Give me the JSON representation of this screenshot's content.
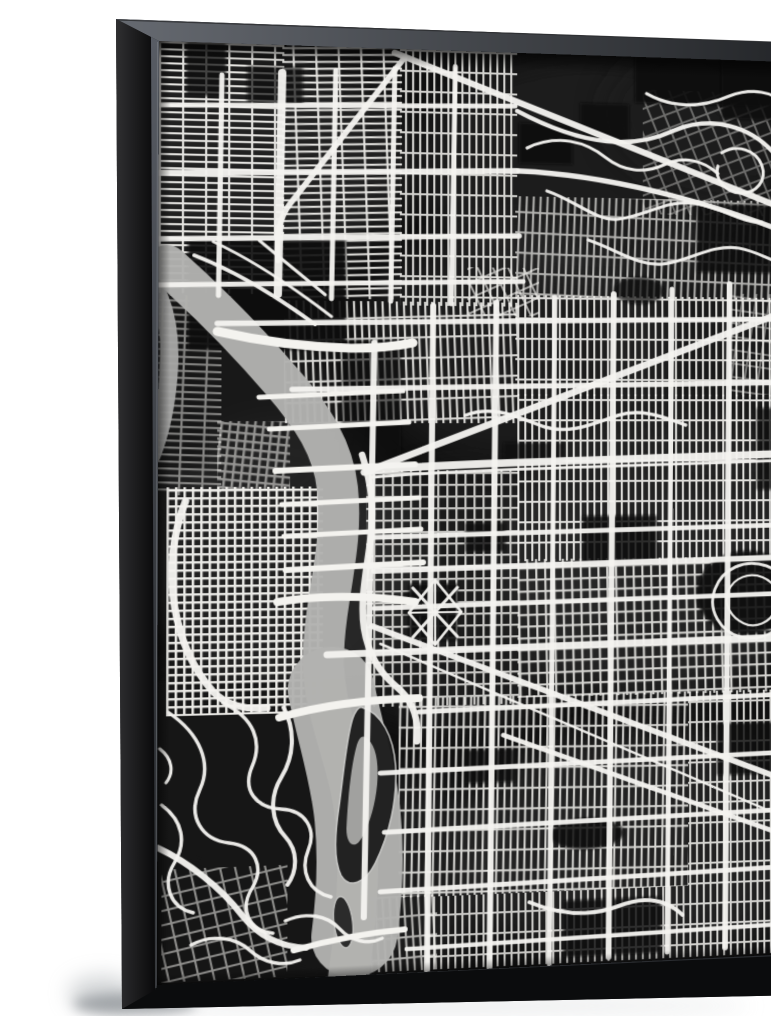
{
  "scene": {
    "description": "Product photo of a gallery-wrapped canvas print in a black floater frame, angled slightly to the right against a white wall with a soft shadow at the lower left. The artwork is a black and white watercolor city street map (Portland, Oregon style): dense white street grids on a dark mottled wash, a light gray river curving from the upper left down through the middle with a dark island, white bridges, diagonal arterials and winding hill roads in the lower left.",
    "wall_color": "#ffffff",
    "shadow_color": "#8b9094"
  },
  "frame": {
    "style": "black floater frame",
    "front_color": "#141517",
    "band_dark": "#0b0c0d",
    "side_light": "#2f2f31",
    "side_dark": "#0a0a0b",
    "bevel_light": "#666a71",
    "bevel_dark": "#232528",
    "left_bevel_light": "#585c64",
    "left_bevel_dark": "#1e2023",
    "lip_highlight": "#a9adb3"
  },
  "artwork": {
    "type": "black-and-white watercolor city street map",
    "palette": {
      "background": "#101010",
      "streets": "#f4f3ef",
      "water": "#b2b2b0",
      "water_dark": "#a7a7a5",
      "island": "#1d1d1d",
      "island_rim": "#c9c9c7",
      "lagoon": "#a9a9a7"
    },
    "map": {
      "grid_types": {
        "h": {
          "tw": 22,
          "th": 7,
          "lw": 2.1
        },
        "v": {
          "tw": 7,
          "th": 21,
          "lw": 2.1
        },
        "fine": {
          "tw": 8,
          "th": 8,
          "lw": 2.4
        },
        "dense2": {
          "tw": 9,
          "th": 12,
          "lw": 2.2
        },
        "coarse": {
          "tw": 14,
          "th": 14,
          "lw": 2.0
        }
      },
      "washes": [
        [
          90,
          120,
          150,
          110,
          "#303030",
          0.5
        ],
        [
          430,
          120,
          180,
          120,
          "#262626",
          0.55
        ],
        [
          500,
          520,
          170,
          150,
          "#343434",
          0.5
        ],
        [
          300,
          560,
          160,
          130,
          "#2a2a2a",
          0.45
        ],
        [
          480,
          820,
          190,
          120,
          "#303030",
          0.5
        ],
        [
          120,
          520,
          130,
          140,
          "#3a3a3a",
          0.4
        ],
        [
          560,
          300,
          120,
          120,
          "#222222",
          0.5
        ],
        [
          200,
          840,
          140,
          100,
          "#2c2c2c",
          0.45
        ],
        [
          350,
          300,
          150,
          120,
          "#333333",
          0.35
        ],
        [
          60,
          380,
          120,
          100,
          "#282828",
          0.4
        ],
        [
          560,
          60,
          120,
          80,
          "#1c1c1c",
          0.6
        ],
        [
          80,
          720,
          120,
          110,
          "#262626",
          0.5
        ]
      ],
      "base_patches": [
        [
          "r",
          0,
          640,
          215,
          300,
          "#121212",
          0.95
        ],
        [
          "r",
          0,
          236,
          46,
          190,
          "#151515",
          0.85
        ]
      ],
      "grids": [
        [
          0,
          0,
          120,
          252,
          "h",
          0,
          0.92
        ],
        [
          118,
          0,
          117,
          256,
          "h",
          -2,
          0.92
        ],
        [
          233,
          0,
          117,
          262,
          "v",
          0,
          0.85
        ],
        [
          348,
          148,
          282,
          104,
          "v",
          2,
          0.7
        ],
        [
          348,
          250,
          282,
          104,
          "v",
          0,
          0.88
        ],
        [
          120,
          258,
          230,
          124,
          "v",
          -2,
          0.88
        ],
        [
          8,
          446,
          150,
          228,
          "fine",
          0,
          0.95
        ],
        [
          200,
          430,
          152,
          240,
          "dense2",
          0,
          0.78
        ],
        [
          350,
          352,
          280,
          172,
          "v",
          0,
          0.9
        ],
        [
          350,
          522,
          280,
          142,
          "dense2",
          -1,
          0.85
        ],
        [
          232,
          662,
          292,
          202,
          "v",
          1,
          0.85
        ],
        [
          258,
          864,
          266,
          74,
          "v",
          0,
          0.8
        ],
        [
          4,
          826,
          120,
          112,
          "coarse",
          -12,
          0.55
        ],
        [
          524,
          662,
          106,
          276,
          "v",
          0,
          0.85
        ],
        [
          204,
          862,
          66,
          76,
          "v",
          -3,
          0.7
        ],
        [
          478,
          34,
          152,
          130,
          "coarse",
          -22,
          0.38
        ],
        [
          300,
          222,
          72,
          50,
          "coarse",
          -25,
          0.65
        ],
        [
          568,
          246,
          62,
          106,
          "coarse",
          8,
          0.45
        ],
        [
          0,
          254,
          60,
          200,
          "h",
          2,
          0.5
        ],
        [
          56,
          380,
          70,
          70,
          "fine",
          6,
          0.55
        ]
      ],
      "patches": [
        [
          "r",
          28,
          196,
          152,
          112,
          "#0b0b0b",
          0.9
        ],
        [
          "r",
          352,
          72,
          54,
          42,
          "#0a0a0a",
          0.88
        ],
        [
          "r",
          414,
          50,
          50,
          40,
          "#0a0a0a",
          0.82
        ],
        [
          "r",
          470,
          0,
          160,
          48,
          "#090909",
          0.9
        ],
        [
          "r",
          534,
          152,
          98,
          72,
          "#0b0b0b",
          0.85
        ],
        [
          "r",
          560,
          0,
          70,
          62,
          "#0a0a0a",
          0.8
        ],
        [
          "r",
          416,
          478,
          76,
          50,
          "#0d0d0d",
          0.85
        ],
        [
          "r",
          298,
          484,
          40,
          30,
          "#0d0d0d",
          0.82
        ],
        [
          "e",
          585,
          560,
          52,
          44,
          "#0a0a0a",
          0.9
        ],
        [
          "r",
          554,
          696,
          76,
          54,
          "#0c0c0c",
          0.82
        ],
        [
          "r",
          298,
          716,
          50,
          34,
          "#0d0d0d",
          0.78
        ],
        [
          "r",
          396,
          874,
          100,
          58,
          "#0c0c0c",
          0.82
        ],
        [
          "r",
          176,
          298,
          58,
          130,
          "#0e0e0e",
          0.6
        ],
        [
          "r",
          26,
          0,
          38,
          54,
          "#0b0b0b",
          0.75
        ],
        [
          "r",
          84,
          22,
          54,
          40,
          "#0b0b0b",
          0.7
        ],
        [
          "r",
          336,
          402,
          62,
          22,
          "#0c0c0c",
          0.65
        ],
        [
          "r",
          236,
          554,
          36,
          24,
          "#0d0d0d",
          0.65
        ],
        [
          "r",
          596,
          366,
          36,
          86,
          "#0b0b0b",
          0.75
        ],
        [
          "e",
          420,
          806,
          38,
          16,
          "#0d0d0d",
          0.85
        ],
        [
          "r",
          242,
          546,
          48,
          58,
          "#0f0f0f",
          0.9
        ],
        [
          "e",
          474,
          244,
          26,
          14,
          "#0b0b0b",
          0.7
        ]
      ],
      "river": {
        "main_d": "M 8 224 C 45 258 85 300 118 340 C 148 376 168 408 172 448 C 176 486 170 520 164 560 C 158 600 156 628 163 664 C 172 706 186 740 190 782 C 194 822 192 862 188 900 C 186 922 184 932 183 944",
        "main_w": 40,
        "wide_d": "M 166 650 C 176 700 188 736 192 780 C 196 822 194 860 189 900",
        "wide_w": 84,
        "sliver_d": "M -4 246 C 8 268 12 300 10 332 C 8 362 2 392 -6 414",
        "sliver_w": 17,
        "island_d": "M 196 670 C 215 676 227 700 229 730 C 231 764 223 800 209 828 C 199 848 184 853 176 839 C 168 822 170 796 174 768 C 178 738 181 700 187 681 C 190 673 193 669 196 670 Z",
        "lagoon_d": "M 199 700 C 209 706 213 724 211 748 C 209 772 201 796 193 806 C 187 812 181 806 181 792 C 182 768 185 730 191 708 C 193 701 196 698 199 700 Z",
        "isle2": [
          178,
          886,
          9,
          26,
          -7
        ]
      },
      "bridges": [
        [
          "M 56 290 C 95 299 140 305 185 306 C 210 306 228 304 246 300",
          9
        ],
        [
          "M 96 356 L 236 349",
          5
        ],
        [
          "M 106 388 L 242 381",
          5
        ],
        [
          "M 112 430 L 248 424",
          6
        ],
        [
          "M 118 464 L 252 458",
          5
        ],
        [
          "M 120 496 L 254 490",
          5
        ],
        [
          "M 122 530 L 256 524",
          6
        ],
        [
          "M 114 562 C 150 556 200 556 248 564",
          8
        ],
        [
          "M 116 678 C 152 668 196 662 252 662",
          8
        ],
        [
          "M 130 912 C 162 904 196 898 238 896",
          6
        ]
      ],
      "roads": [
        [
          "M 26 460 C 14 492 10 530 16 566 C 22 602 34 628 52 650 C 64 664 84 670 104 668",
          7
        ],
        [
          "M 196 414 C 206 446 208 472 204 502 C 200 534 194 562 198 590 C 202 616 214 636 230 650 C 246 664 252 684 250 706",
          6.5
        ],
        [
          "M 56 282 L 632 272",
          5.5
        ],
        [
          "M 128 348 L 632 339",
          5.5
        ],
        [
          "M 202 430 C 300 422 460 420 632 414",
          8
        ],
        [
          "M 206 437 C 300 429 460 427 632 421",
          3
        ],
        [
          "M 206 498 L 632 489",
          5
        ],
        [
          "M 208 532 L 632 523",
          6
        ],
        [
          "M 208 570 L 632 561",
          5
        ],
        [
          "M 162 616 L 632 607",
          7
        ],
        [
          "M 252 676 L 632 667",
          5
        ],
        [
          "M 214 737 L 632 728",
          5
        ],
        [
          "M 218 797 L 632 788",
          5
        ],
        [
          "M 214 857 L 632 848",
          5
        ],
        [
          "M 240 916 L 632 908",
          4.5
        ],
        [
          "M 208 300 C 204 480 202 700 198 882",
          6
        ],
        [
          "M 266 262 L 260 938",
          6
        ],
        [
          "M 329 258 L 322 938",
          6
        ],
        [
          "M 388 252 L 382 938",
          5
        ],
        [
          "M 448 248 L 442 934",
          6
        ],
        [
          "M 508 242 L 502 932",
          5
        ],
        [
          "M 568 236 L 562 930",
          6
        ],
        [
          "M 626 232 L 620 928",
          5
        ],
        [
          "M 118 28 L 114 252",
          8
        ],
        [
          "M 170 24 L 166 256",
          5
        ],
        [
          "M 60 32 L 57 254",
          5
        ],
        [
          "M 228 20 L 224 258",
          5
        ],
        [
          "M 288 16 L 284 260",
          5
        ],
        [
          "M 0 64 L 348 55",
          5
        ],
        [
          "M 0 132 L 350 122",
          6
        ],
        [
          "M 0 198 L 352 189",
          5.5
        ],
        [
          "M 0 244 L 356 236",
          5
        ],
        [
          "M 228 4 L 632 158",
          6.5
        ],
        [
          "M 352 122 C 440 124 540 148 632 182",
          5.5
        ],
        [
          "M 238 8 L 126 160 C 114 176 112 196 114 218",
          5.5
        ],
        [
          "M 198 432 L 632 262",
          7
        ],
        [
          "M 206 588 L 632 760",
          6
        ],
        [
          "M 214 606 L 632 800",
          2.5
        ],
        [
          "M 336 702 L 632 818",
          5
        ],
        [
          "M 298 374 C 328 362 354 378 378 386 C 404 394 428 382 452 374 C 476 366 500 376 522 384",
          3.5
        ],
        [
          "M 120 668 C 132 692 130 718 118 738 C 106 758 108 782 122 798 C 134 812 134 832 124 846",
          4
        ],
        [
          "M 360 98 C 390 82 420 90 440 106 C 458 120 480 122 500 112 C 520 102 540 106 556 120",
          3.2
        ],
        [
          "M 380 142 C 410 152 430 172 452 170 C 482 166 502 148 532 152 C 562 156 582 172 602 170",
          3.2
        ],
        [
          "M 560 98 C 576 88 596 94 602 110 C 608 126 596 140 580 140 C 564 140 552 126 556 112",
          3.2
        ],
        [
          "M 482 38 C 512 54 542 50 568 38 C 592 28 614 32 630 46",
          3.2
        ],
        [
          "M 422 192 C 452 202 472 218 498 216 C 528 212 548 194 578 198 C 602 202 618 216 630 212",
          3.2
        ],
        [
          "M 350 60 C 420 96 470 96 510 76 C 550 58 590 70 614 96 C 628 112 630 130 626 150",
          4.5
        ],
        [
          "M 10 670 C 40 692 52 722 40 748 C 28 774 42 798 68 802 C 94 806 102 828 90 848 C 78 868 86 890 110 894",
          3.4
        ],
        [
          "M 62 662 C 92 678 100 702 90 726 C 80 750 94 768 118 770 C 142 772 152 792 144 812 C 136 832 144 854 166 860",
          3.4
        ],
        [
          "M 4 762 C 24 778 28 800 16 820 C 4 840 12 864 34 870",
          3.4
        ],
        [
          "M 122 882 C 142 874 162 878 174 892 C 186 906 202 910 216 904",
          3.4
        ],
        [
          "M 32 902 C 52 892 74 896 88 910 C 102 924 120 928 136 922",
          3.4
        ],
        [
          "M 2 706 C 14 716 16 730 8 740",
          3
        ],
        [
          "M 0 804 C 30 820 60 846 80 874 C 96 896 118 908 142 910",
          6
        ],
        [
          "M 362 874 C 392 888 422 892 452 882 C 482 872 502 878 518 894",
          4
        ],
        [
          "M 34 214 C 70 228 110 252 150 282",
          4
        ],
        [
          "M 52 200 C 90 218 128 244 166 274",
          3
        ],
        [
          "M 96 198 L 160 252",
          3
        ],
        [
          "M 552 556 C 560 534 584 524 606 532 C 628 540 638 562 630 582 C 622 602 598 612 578 606 C 558 600 544 578 552 556",
          3
        ],
        [
          "M 566 558 C 572 544 588 538 602 544 C 616 550 622 564 616 578 C 610 592 594 598 582 592 C 570 586 560 572 566 558",
          2.4
        ],
        [
          "M 246 550 L 290 600",
          3.2
        ],
        [
          "M 290 550 L 246 600",
          3.2
        ],
        [
          "M 268 542 L 294 575 L 268 608 L 242 575 Z",
          2.8
        ],
        [
          "M 268 542 L 268 608",
          2.2
        ],
        [
          "M 242 575 L 294 575",
          2.2
        ]
      ]
    }
  }
}
